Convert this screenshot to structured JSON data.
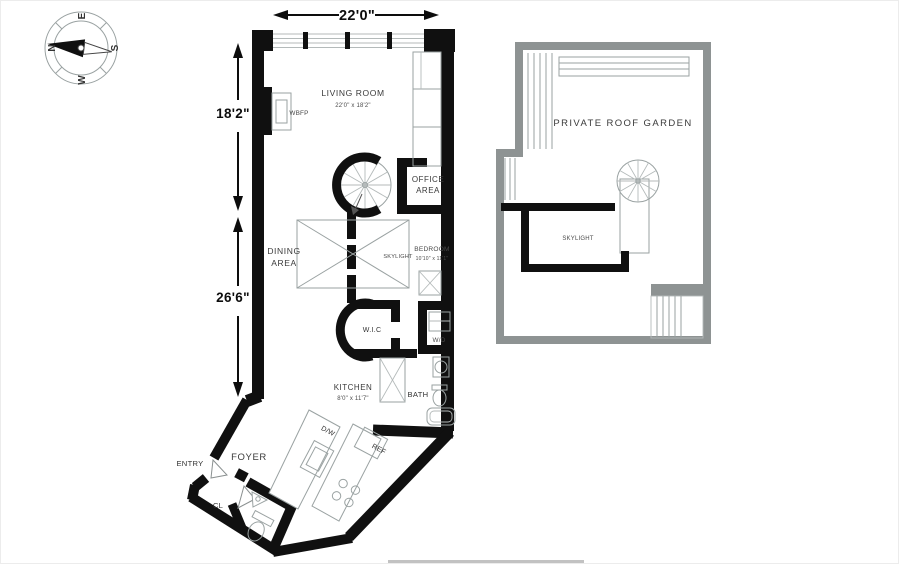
{
  "compass": {
    "n": "N",
    "e": "E",
    "s": "S",
    "w": "W"
  },
  "dimensions": {
    "width_top": "22'0\"",
    "height_upper": "18'2\"",
    "height_lower": "26'6\""
  },
  "main_floor": {
    "living_room": {
      "name": "LIVING ROOM",
      "size": "22'0\" x 18'2\""
    },
    "fireplace": "WBFP",
    "office_area": {
      "line1": "OFFICE",
      "line2": "AREA"
    },
    "dining_area": {
      "line1": "DINING",
      "line2": "AREA"
    },
    "skylight": "SKYLIGHT",
    "bedroom": {
      "name": "BEDROOM",
      "size": "10'10\" x 11'1\""
    },
    "walk_in_closet": "W.I.C",
    "washer_dryer": "W/D",
    "kitchen": {
      "name": "KITCHEN",
      "size": "8'0\" x 11'7\""
    },
    "bath": "BATH",
    "dishwasher": "D/W",
    "refrigerator": "REF",
    "entry": "ENTRY",
    "foyer": "FOYER",
    "closet": "CL"
  },
  "roof_plan": {
    "name": "PRIVATE ROOF GARDEN",
    "skylight": "SKYLIGHT"
  },
  "colors": {
    "wall": "#101010",
    "roof_wall": "#8e9393",
    "thin_line": "#9aa2a2",
    "text": "#3a3a3a",
    "background": "#ffffff"
  }
}
